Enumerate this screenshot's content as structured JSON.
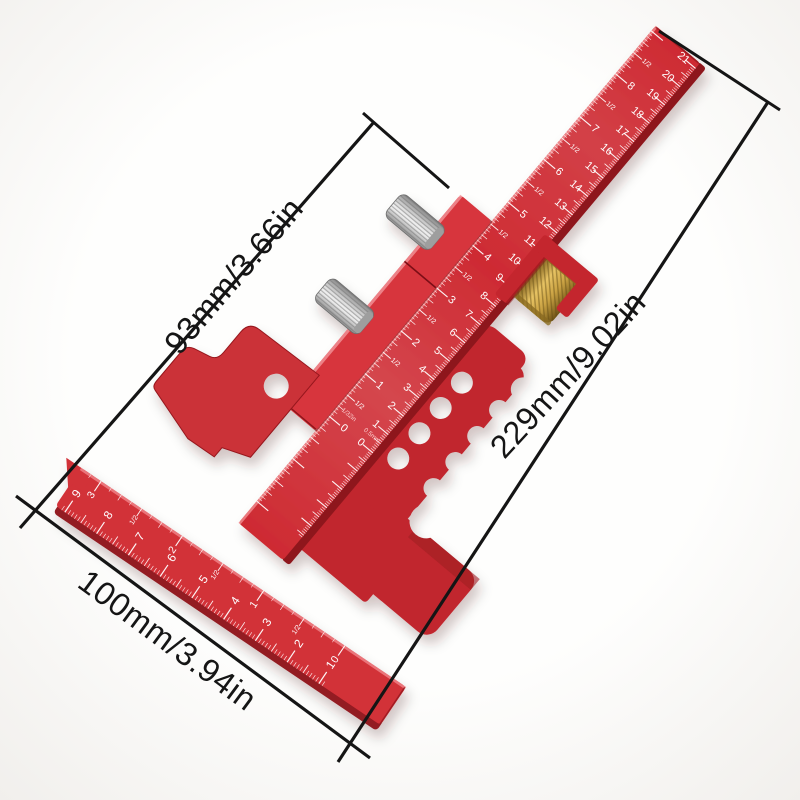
{
  "annotations": {
    "slider_dimension": "93mm/3.66in",
    "beam_dimension": "229mm/9.02in",
    "cross_dimension": "100mm/3.94in"
  },
  "beam_ruler": {
    "cm_labels": [
      "0",
      "1",
      "2",
      "3",
      "4",
      "5",
      "6",
      "7",
      "8",
      "9",
      "10",
      "11",
      "12",
      "13",
      "14",
      "15",
      "16",
      "17",
      "18",
      "19",
      "20",
      "21"
    ],
    "inch_labels": [
      "0",
      "1",
      "2",
      "3",
      "4",
      "5",
      "6",
      "7",
      "8"
    ],
    "half_label": "1/2",
    "inch_note": "1/32in",
    "cm_note": "0.5mm"
  },
  "cross_ruler": {
    "cm_labels": [
      "1",
      "2",
      "3",
      "4",
      "5",
      "6",
      "7",
      "8",
      "9"
    ],
    "inch_labels": [
      "0",
      "1",
      "2",
      "3"
    ],
    "half_label": "1/2"
  },
  "colors": {
    "beam": "#ce2b33",
    "beam_side": "#8e191e",
    "beam_hi": "#f0868a",
    "body": "#c1262e",
    "rail": "#d7353d",
    "plate": "#cb3038",
    "bracket": "#c4252d",
    "cross": "#d23039",
    "cross_side": "#931a20",
    "cross_hi": "#ee8186",
    "brass_bright": "#e7c364",
    "brass_dark": "#7c5c1a",
    "steel_bright": "#f4f4f4",
    "steel_dark": "#8f8f8f",
    "marks": "#ffffff",
    "dimension": "#151515"
  }
}
